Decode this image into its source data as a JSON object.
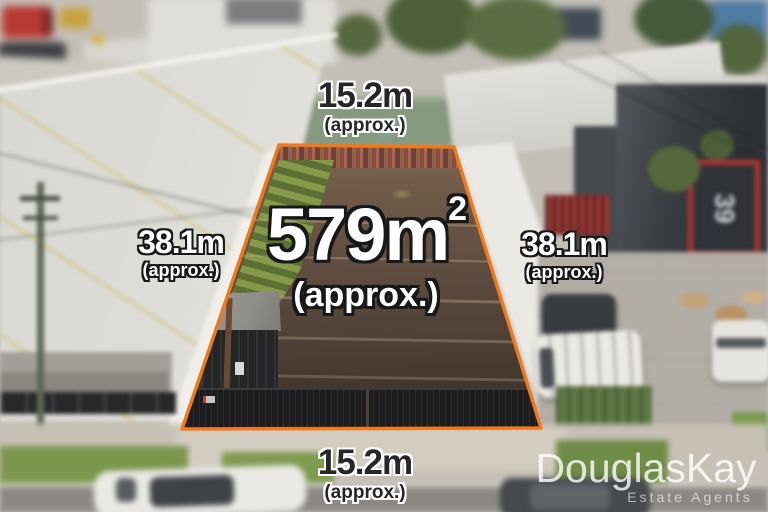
{
  "branding": {
    "agency_name": "DouglasKay",
    "agency_tagline": "Estate Agents"
  },
  "property": {
    "area_value": "579m",
    "area_superscript": "2",
    "area_qualifier": "(approx.)",
    "frontage_top": {
      "value": "15.2m",
      "qualifier": "(approx.)"
    },
    "depth_left": {
      "value": "38.1m",
      "qualifier": "(approx.)"
    },
    "depth_right": {
      "value": "38.1m",
      "qualifier": "(approx.)"
    },
    "frontage_bottom": {
      "value": "15.2m",
      "qualifier": "(approx.)"
    },
    "boundary_color": "#EE7A1D"
  },
  "scene": {
    "neighbor_building_sign": "39"
  }
}
